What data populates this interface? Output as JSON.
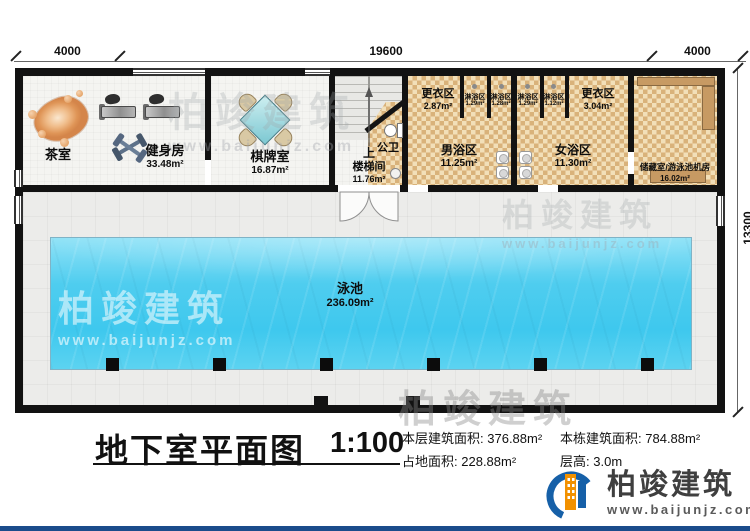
{
  "plan": {
    "dims": {
      "top_left": "4000",
      "top_middle": "19600",
      "top_right": "4000",
      "right": "13300"
    },
    "rooms": {
      "tea": {
        "name": "茶室"
      },
      "gym": {
        "name": "健身房",
        "area": "33.48m²"
      },
      "chess": {
        "name": "棋牌室",
        "area": "16.87m²"
      },
      "stair": {
        "up": "上",
        "name": "楼梯间",
        "area": "11.76m²"
      },
      "wc": {
        "name": "公卫"
      },
      "locker_l": {
        "name": "更衣区",
        "area": "2.87m²"
      },
      "male": {
        "name": "男浴区",
        "area": "11.25m²"
      },
      "female": {
        "name": "女浴区",
        "area": "11.30m²"
      },
      "locker_r": {
        "name": "更衣区",
        "area": "3.04m²"
      },
      "storage": {
        "name": "储藏室/游泳池机房",
        "area": "16.02m²"
      },
      "pool": {
        "name": "泳池",
        "area": "236.09m²"
      },
      "showers": [
        {
          "name": "淋浴区",
          "area": "1.29m²"
        },
        {
          "name": "淋浴区",
          "area": "1.28m²"
        },
        {
          "name": "淋浴区",
          "area": "1.29m²"
        },
        {
          "name": "淋浴区",
          "area": "1.12m²"
        }
      ]
    }
  },
  "title_block": {
    "title": "地下室平面图",
    "scale": "1:100",
    "stats": [
      {
        "label": "本层建筑面积:",
        "value": "376.88m²"
      },
      {
        "label": "本栋建筑面积:",
        "value": "784.88m²"
      },
      {
        "label": "占地面积:",
        "value": "228.88m²"
      },
      {
        "label": "层高:",
        "value": "3.0m"
      }
    ]
  },
  "branding": {
    "name": "柏竣建筑",
    "url": "www.baijunjz.com"
  },
  "watermark": {
    "name": "柏竣建筑",
    "url": "www.baijunjz.com"
  },
  "colors": {
    "wall": "#121212",
    "tile": "#d9b27a",
    "water": "#3ec8ee",
    "accent_blue": "#1660a8",
    "accent_orange": "#f29100",
    "footer_bar": "#1a4c8b"
  }
}
